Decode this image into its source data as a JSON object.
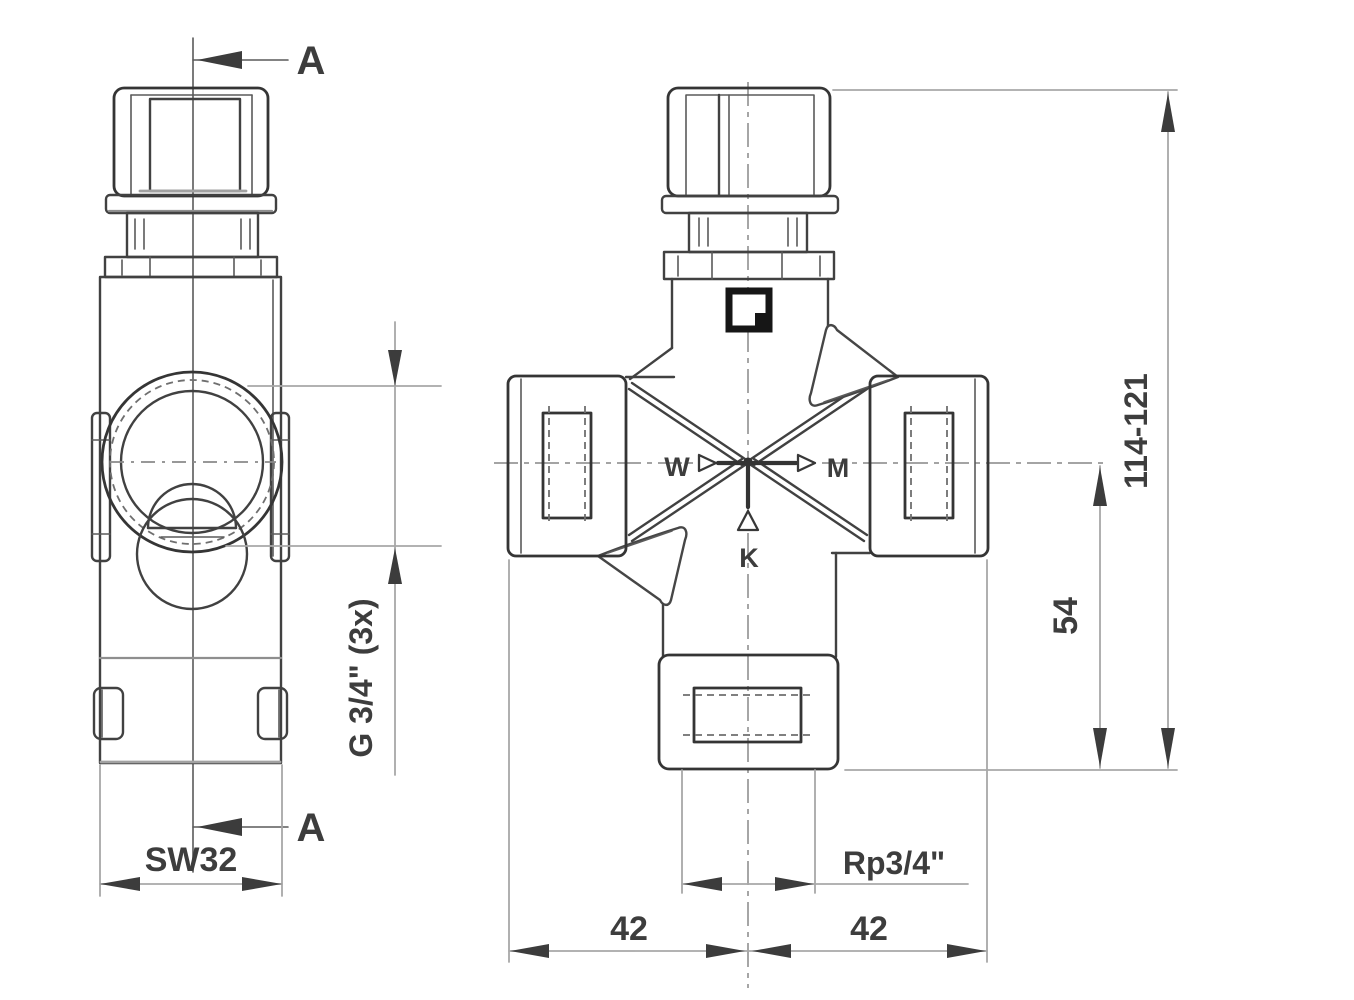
{
  "colors": {
    "background": "#ffffff",
    "outline": "#414141",
    "dimension_line": "#a8a8a8",
    "label_text": "#3d3d3d"
  },
  "side_view": {
    "section_label_top": "A",
    "section_label_bottom": "A",
    "wrench_size": "SW32",
    "side_ports_thread": "G 3/4\" (3x)"
  },
  "front_view": {
    "flow_left": "W",
    "flow_right": "M",
    "flow_bottom": "K",
    "overall_height": "114-121",
    "center_to_bottom": "54",
    "bottom_thread": "Rp3/4\"",
    "width_left": "42",
    "width_right": "42"
  }
}
